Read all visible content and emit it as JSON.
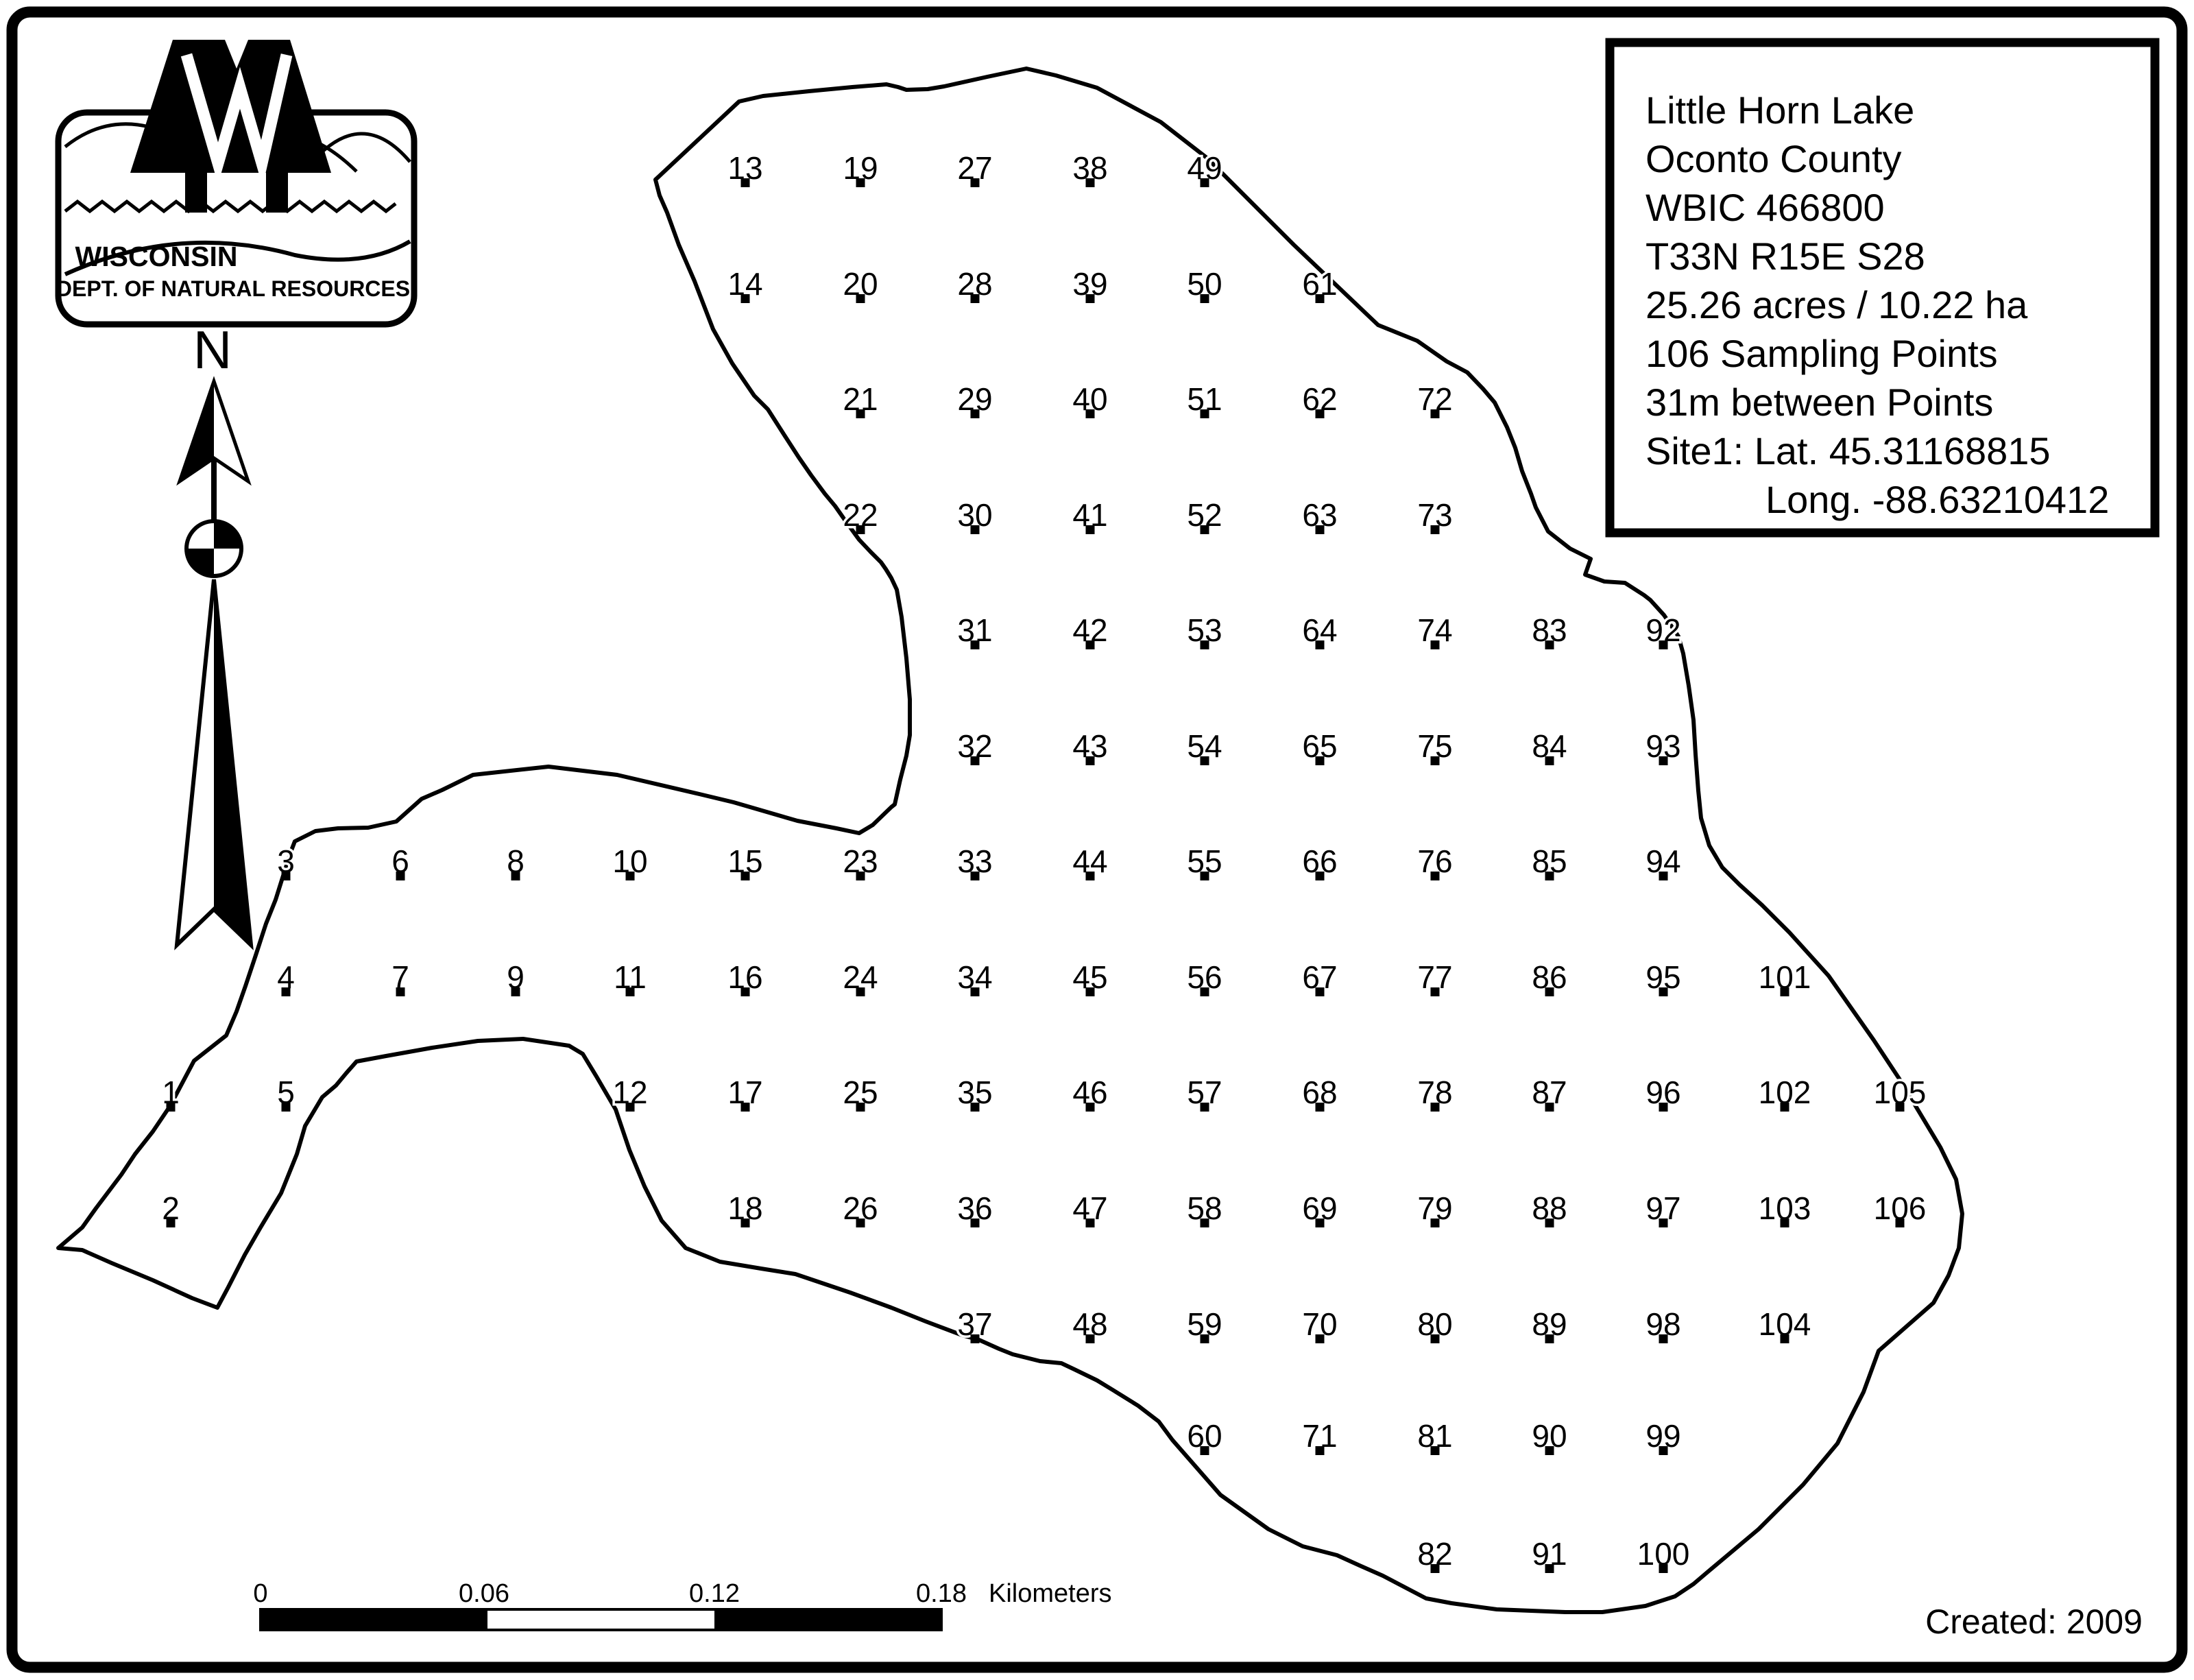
{
  "page": {
    "background": "#ffffff",
    "ink": "#000000"
  },
  "logo": {
    "org_line1": "WISCONSIN",
    "org_line2": "DEPT. OF NATURAL RESOURCES"
  },
  "compass": {
    "label": "N"
  },
  "info_box": {
    "lines": [
      "Little Horn Lake",
      "Oconto County",
      "WBIC 466800",
      "T33N R15E S28",
      "25.26 acres / 10.22 ha",
      "106 Sampling Points",
      "31m between Points",
      "Site1: Lat. 45.31168815",
      "Long. -88.63210412"
    ]
  },
  "scale_bar": {
    "tick_labels": [
      "0",
      "0.06",
      "0.12",
      "0.18"
    ],
    "unit_label": "Kilometers"
  },
  "footer": {
    "created_label": "Created: 2009"
  },
  "lake": {
    "grid_cols_x": [
      249,
      417,
      584,
      752,
      919,
      1087,
      1255,
      1422,
      1590,
      1757,
      1925,
      2093,
      2260,
      2426,
      2603,
      2771
    ],
    "grid_rows_y": [
      245,
      414,
      582,
      751,
      919,
      1088,
      1256,
      1425,
      1593,
      1762,
      1931,
      2094,
      2266
    ],
    "points": [
      {
        "n": 1,
        "c": 0,
        "r": 8
      },
      {
        "n": 2,
        "c": 0,
        "r": 9
      },
      {
        "n": 3,
        "c": 1,
        "r": 6
      },
      {
        "n": 4,
        "c": 1,
        "r": 7
      },
      {
        "n": 5,
        "c": 1,
        "r": 8
      },
      {
        "n": 6,
        "c": 2,
        "r": 6
      },
      {
        "n": 7,
        "c": 2,
        "r": 7
      },
      {
        "n": 8,
        "c": 3,
        "r": 6
      },
      {
        "n": 9,
        "c": 3,
        "r": 7
      },
      {
        "n": 10,
        "c": 4,
        "r": 6
      },
      {
        "n": 11,
        "c": 4,
        "r": 7
      },
      {
        "n": 12,
        "c": 4,
        "r": 8
      },
      {
        "n": 13,
        "c": 5,
        "r": 0
      },
      {
        "n": 14,
        "c": 5,
        "r": 1
      },
      {
        "n": 15,
        "c": 5,
        "r": 6
      },
      {
        "n": 16,
        "c": 5,
        "r": 7
      },
      {
        "n": 17,
        "c": 5,
        "r": 8
      },
      {
        "n": 18,
        "c": 5,
        "r": 9
      },
      {
        "n": 19,
        "c": 6,
        "r": 0
      },
      {
        "n": 20,
        "c": 6,
        "r": 1
      },
      {
        "n": 21,
        "c": 6,
        "r": 2
      },
      {
        "n": 22,
        "c": 6,
        "r": 3
      },
      {
        "n": 23,
        "c": 6,
        "r": 6
      },
      {
        "n": 24,
        "c": 6,
        "r": 7
      },
      {
        "n": 25,
        "c": 6,
        "r": 8
      },
      {
        "n": 26,
        "c": 6,
        "r": 9
      },
      {
        "n": 27,
        "c": 7,
        "r": 0
      },
      {
        "n": 28,
        "c": 7,
        "r": 1
      },
      {
        "n": 29,
        "c": 7,
        "r": 2
      },
      {
        "n": 30,
        "c": 7,
        "r": 3
      },
      {
        "n": 31,
        "c": 7,
        "r": 4
      },
      {
        "n": 32,
        "c": 7,
        "r": 5
      },
      {
        "n": 33,
        "c": 7,
        "r": 6
      },
      {
        "n": 34,
        "c": 7,
        "r": 7
      },
      {
        "n": 35,
        "c": 7,
        "r": 8
      },
      {
        "n": 36,
        "c": 7,
        "r": 9
      },
      {
        "n": 37,
        "c": 7,
        "r": 10
      },
      {
        "n": 38,
        "c": 8,
        "r": 0
      },
      {
        "n": 39,
        "c": 8,
        "r": 1
      },
      {
        "n": 40,
        "c": 8,
        "r": 2
      },
      {
        "n": 41,
        "c": 8,
        "r": 3
      },
      {
        "n": 42,
        "c": 8,
        "r": 4
      },
      {
        "n": 43,
        "c": 8,
        "r": 5
      },
      {
        "n": 44,
        "c": 8,
        "r": 6
      },
      {
        "n": 45,
        "c": 8,
        "r": 7
      },
      {
        "n": 46,
        "c": 8,
        "r": 8
      },
      {
        "n": 47,
        "c": 8,
        "r": 9
      },
      {
        "n": 48,
        "c": 8,
        "r": 10
      },
      {
        "n": 49,
        "c": 9,
        "r": 0
      },
      {
        "n": 50,
        "c": 9,
        "r": 1
      },
      {
        "n": 51,
        "c": 9,
        "r": 2
      },
      {
        "n": 52,
        "c": 9,
        "r": 3
      },
      {
        "n": 53,
        "c": 9,
        "r": 4
      },
      {
        "n": 54,
        "c": 9,
        "r": 5
      },
      {
        "n": 55,
        "c": 9,
        "r": 6
      },
      {
        "n": 56,
        "c": 9,
        "r": 7
      },
      {
        "n": 57,
        "c": 9,
        "r": 8
      },
      {
        "n": 58,
        "c": 9,
        "r": 9
      },
      {
        "n": 59,
        "c": 9,
        "r": 10
      },
      {
        "n": 60,
        "c": 9,
        "r": 11
      },
      {
        "n": 61,
        "c": 10,
        "r": 1
      },
      {
        "n": 62,
        "c": 10,
        "r": 2
      },
      {
        "n": 63,
        "c": 10,
        "r": 3
      },
      {
        "n": 64,
        "c": 10,
        "r": 4
      },
      {
        "n": 65,
        "c": 10,
        "r": 5
      },
      {
        "n": 66,
        "c": 10,
        "r": 6
      },
      {
        "n": 67,
        "c": 10,
        "r": 7
      },
      {
        "n": 68,
        "c": 10,
        "r": 8
      },
      {
        "n": 69,
        "c": 10,
        "r": 9
      },
      {
        "n": 70,
        "c": 10,
        "r": 10
      },
      {
        "n": 71,
        "c": 10,
        "r": 11
      },
      {
        "n": 72,
        "c": 11,
        "r": 2
      },
      {
        "n": 73,
        "c": 11,
        "r": 3
      },
      {
        "n": 74,
        "c": 11,
        "r": 4
      },
      {
        "n": 75,
        "c": 11,
        "r": 5
      },
      {
        "n": 76,
        "c": 11,
        "r": 6
      },
      {
        "n": 77,
        "c": 11,
        "r": 7
      },
      {
        "n": 78,
        "c": 11,
        "r": 8
      },
      {
        "n": 79,
        "c": 11,
        "r": 9
      },
      {
        "n": 80,
        "c": 11,
        "r": 10
      },
      {
        "n": 81,
        "c": 11,
        "r": 11
      },
      {
        "n": 82,
        "c": 11,
        "r": 12
      },
      {
        "n": 83,
        "c": 12,
        "r": 4
      },
      {
        "n": 84,
        "c": 12,
        "r": 5
      },
      {
        "n": 85,
        "c": 12,
        "r": 6
      },
      {
        "n": 86,
        "c": 12,
        "r": 7
      },
      {
        "n": 87,
        "c": 12,
        "r": 8
      },
      {
        "n": 88,
        "c": 12,
        "r": 9
      },
      {
        "n": 89,
        "c": 12,
        "r": 10
      },
      {
        "n": 90,
        "c": 12,
        "r": 11
      },
      {
        "n": 91,
        "c": 12,
        "r": 12
      },
      {
        "n": 92,
        "c": 13,
        "r": 4
      },
      {
        "n": 93,
        "c": 13,
        "r": 5
      },
      {
        "n": 94,
        "c": 13,
        "r": 6
      },
      {
        "n": 95,
        "c": 13,
        "r": 7
      },
      {
        "n": 96,
        "c": 13,
        "r": 8
      },
      {
        "n": 97,
        "c": 13,
        "r": 9
      },
      {
        "n": 98,
        "c": 13,
        "r": 10
      },
      {
        "n": 99,
        "c": 13,
        "r": 11
      },
      {
        "n": 100,
        "c": 13,
        "r": 12
      },
      {
        "n": 101,
        "c": 14,
        "r": 7
      },
      {
        "n": 102,
        "c": 14,
        "r": 8
      },
      {
        "n": 103,
        "c": 14,
        "r": 9
      },
      {
        "n": 104,
        "c": 14,
        "r": 10
      },
      {
        "n": 105,
        "c": 15,
        "r": 8
      },
      {
        "n": 106,
        "c": 15,
        "r": 9
      }
    ],
    "outline": [
      [
        956,
        262
      ],
      [
        1078,
        148
      ],
      [
        1113,
        140
      ],
      [
        1180,
        133
      ],
      [
        1243,
        127
      ],
      [
        1293,
        123
      ],
      [
        1310,
        127
      ],
      [
        1322,
        131
      ],
      [
        1353,
        130
      ],
      [
        1377,
        126
      ],
      [
        1440,
        112
      ],
      [
        1497,
        100
      ],
      [
        1540,
        110
      ],
      [
        1600,
        128
      ],
      [
        1693,
        178
      ],
      [
        1760,
        230
      ],
      [
        1800,
        270
      ],
      [
        1887,
        357
      ],
      [
        2010,
        474
      ],
      [
        2067,
        497
      ],
      [
        2110,
        527
      ],
      [
        2140,
        543
      ],
      [
        2163,
        567
      ],
      [
        2180,
        587
      ],
      [
        2198,
        623
      ],
      [
        2210,
        653
      ],
      [
        2220,
        687
      ],
      [
        2233,
        720
      ],
      [
        2240,
        740
      ],
      [
        2258,
        775
      ],
      [
        2290,
        800
      ],
      [
        2320,
        815
      ],
      [
        2312,
        838
      ],
      [
        2340,
        848
      ],
      [
        2370,
        850
      ],
      [
        2398,
        868
      ],
      [
        2407,
        875
      ],
      [
        2427,
        897
      ],
      [
        2448,
        928
      ],
      [
        2455,
        953
      ],
      [
        2463,
        1000
      ],
      [
        2470,
        1050
      ],
      [
        2473,
        1100
      ],
      [
        2477,
        1153
      ],
      [
        2481,
        1193
      ],
      [
        2493,
        1233
      ],
      [
        2512,
        1265
      ],
      [
        2537,
        1290
      ],
      [
        2570,
        1320
      ],
      [
        2610,
        1360
      ],
      [
        2667,
        1423
      ],
      [
        2700,
        1470
      ],
      [
        2733,
        1517
      ],
      [
        2770,
        1573
      ],
      [
        2800,
        1623
      ],
      [
        2830,
        1673
      ],
      [
        2853,
        1720
      ],
      [
        2862,
        1770
      ],
      [
        2857,
        1820
      ],
      [
        2842,
        1860
      ],
      [
        2820,
        1900
      ],
      [
        2780,
        1935
      ],
      [
        2740,
        1970
      ],
      [
        2718,
        2030
      ],
      [
        2680,
        2105
      ],
      [
        2630,
        2165
      ],
      [
        2565,
        2230
      ],
      [
        2490,
        2293
      ],
      [
        2470,
        2310
      ],
      [
        2443,
        2328
      ],
      [
        2400,
        2342
      ],
      [
        2337,
        2351
      ],
      [
        2283,
        2351
      ],
      [
        2183,
        2347
      ],
      [
        2117,
        2338
      ],
      [
        2080,
        2331
      ],
      [
        2017,
        2298
      ],
      [
        1983,
        2283
      ],
      [
        1950,
        2268
      ],
      [
        1900,
        2255
      ],
      [
        1850,
        2230
      ],
      [
        1780,
        2180
      ],
      [
        1710,
        2100
      ],
      [
        1690,
        2073
      ],
      [
        1660,
        2050
      ],
      [
        1623,
        2027
      ],
      [
        1600,
        2013
      ],
      [
        1567,
        1997
      ],
      [
        1548,
        1988
      ],
      [
        1517,
        1985
      ],
      [
        1477,
        1975
      ],
      [
        1457,
        1967
      ],
      [
        1428,
        1954
      ],
      [
        1403,
        1947
      ],
      [
        1350,
        1927
      ],
      [
        1300,
        1907
      ],
      [
        1240,
        1885
      ],
      [
        1160,
        1858
      ],
      [
        1110,
        1850
      ],
      [
        1050,
        1840
      ],
      [
        1000,
        1820
      ],
      [
        965,
        1780
      ],
      [
        940,
        1730
      ],
      [
        918,
        1677
      ],
      [
        898,
        1618
      ],
      [
        870,
        1570
      ],
      [
        850,
        1537
      ],
      [
        830,
        1525
      ],
      [
        763,
        1515
      ],
      [
        697,
        1518
      ],
      [
        630,
        1528
      ],
      [
        563,
        1540
      ],
      [
        520,
        1548
      ],
      [
        505,
        1565
      ],
      [
        490,
        1583
      ],
      [
        470,
        1600
      ],
      [
        445,
        1642
      ],
      [
        433,
        1683
      ],
      [
        410,
        1740
      ],
      [
        380,
        1790
      ],
      [
        357,
        1830
      ],
      [
        333,
        1877
      ],
      [
        317,
        1907
      ],
      [
        280,
        1893
      ],
      [
        223,
        1867
      ],
      [
        163,
        1842
      ],
      [
        120,
        1823
      ],
      [
        85,
        1820
      ],
      [
        120,
        1790
      ],
      [
        140,
        1762
      ],
      [
        177,
        1713
      ],
      [
        197,
        1683
      ],
      [
        223,
        1650
      ],
      [
        248,
        1613
      ],
      [
        283,
        1547
      ],
      [
        330,
        1510
      ],
      [
        345,
        1475
      ],
      [
        358,
        1438
      ],
      [
        373,
        1393
      ],
      [
        388,
        1347
      ],
      [
        402,
        1312
      ],
      [
        413,
        1277
      ],
      [
        425,
        1240
      ],
      [
        430,
        1227
      ],
      [
        460,
        1212
      ],
      [
        493,
        1208
      ],
      [
        537,
        1207
      ],
      [
        578,
        1198
      ],
      [
        615,
        1165
      ],
      [
        645,
        1152
      ],
      [
        690,
        1130
      ],
      [
        800,
        1118
      ],
      [
        900,
        1130
      ],
      [
        1020,
        1158
      ],
      [
        1070,
        1170
      ],
      [
        1163,
        1197
      ],
      [
        1220,
        1208
      ],
      [
        1253,
        1215
      ],
      [
        1273,
        1203
      ],
      [
        1300,
        1177
      ],
      [
        1305,
        1173
      ],
      [
        1313,
        1137
      ],
      [
        1322,
        1102
      ],
      [
        1327,
        1072
      ],
      [
        1327,
        1020
      ],
      [
        1322,
        960
      ],
      [
        1315,
        900
      ],
      [
        1308,
        860
      ],
      [
        1300,
        843
      ],
      [
        1292,
        830
      ],
      [
        1285,
        820
      ],
      [
        1270,
        805
      ],
      [
        1253,
        787
      ],
      [
        1232,
        758
      ],
      [
        1218,
        738
      ],
      [
        1203,
        720
      ],
      [
        1183,
        693
      ],
      [
        1165,
        667
      ],
      [
        1143,
        633
      ],
      [
        1120,
        597
      ],
      [
        1100,
        577
      ],
      [
        1068,
        530
      ],
      [
        1040,
        480
      ],
      [
        1013,
        410
      ],
      [
        990,
        357
      ],
      [
        973,
        310
      ],
      [
        962,
        285
      ]
    ]
  }
}
